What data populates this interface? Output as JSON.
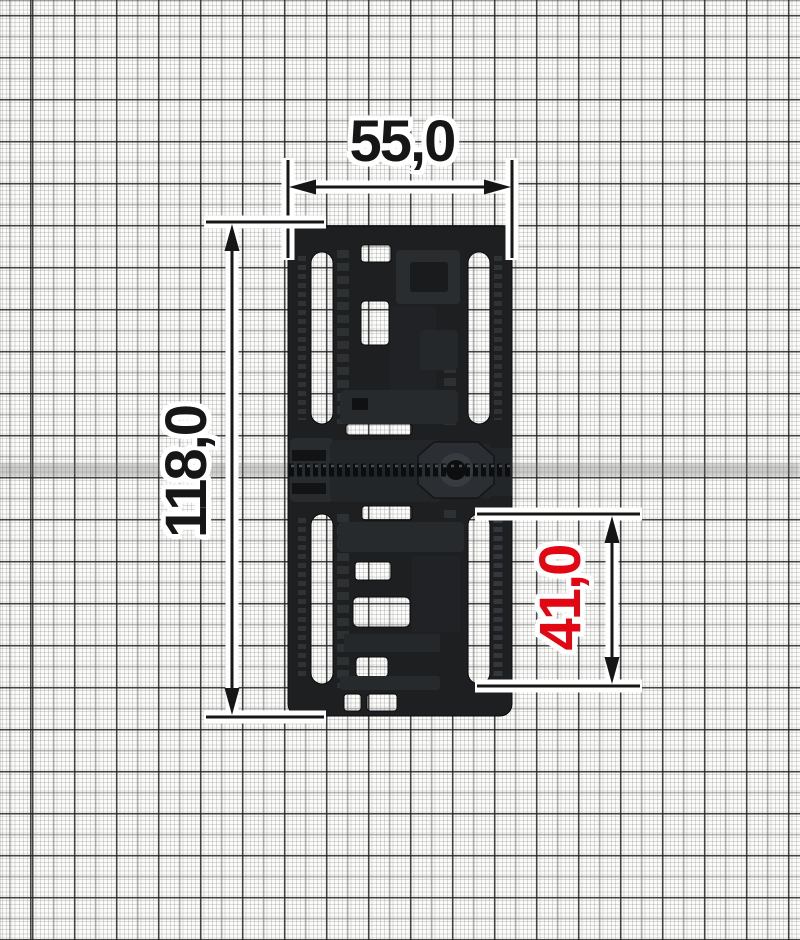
{
  "drawing_title": "adjustable buckle technical drawing on millimeter graph paper",
  "part": {
    "description": "black plastic multi-slot strap adjuster buckle, top view",
    "color": "#1d1f21",
    "slot_count": 4
  },
  "dimensions": {
    "width_top": {
      "label": "55,0",
      "value": 55.0,
      "orientation": "horizontal",
      "color": "#161616"
    },
    "height_left": {
      "label": "118,0",
      "value": 118.0,
      "orientation": "vertical",
      "color": "#161616"
    },
    "slot_right": {
      "label": "41,0",
      "value": 41.0,
      "orientation": "vertical",
      "color": "#e30613"
    }
  },
  "colors": {
    "accent_red": "#e30613",
    "line_black": "#161616",
    "text_black": "#161616",
    "part_dark": "#1d1f21",
    "part_mid": "#26292c",
    "part_light": "#34383c",
    "paper_white": "#fbfbfa"
  },
  "graph_paper": {
    "fine_cell_px": 4.2,
    "medium_cell_px": 21,
    "bold_cell_px": 42
  }
}
